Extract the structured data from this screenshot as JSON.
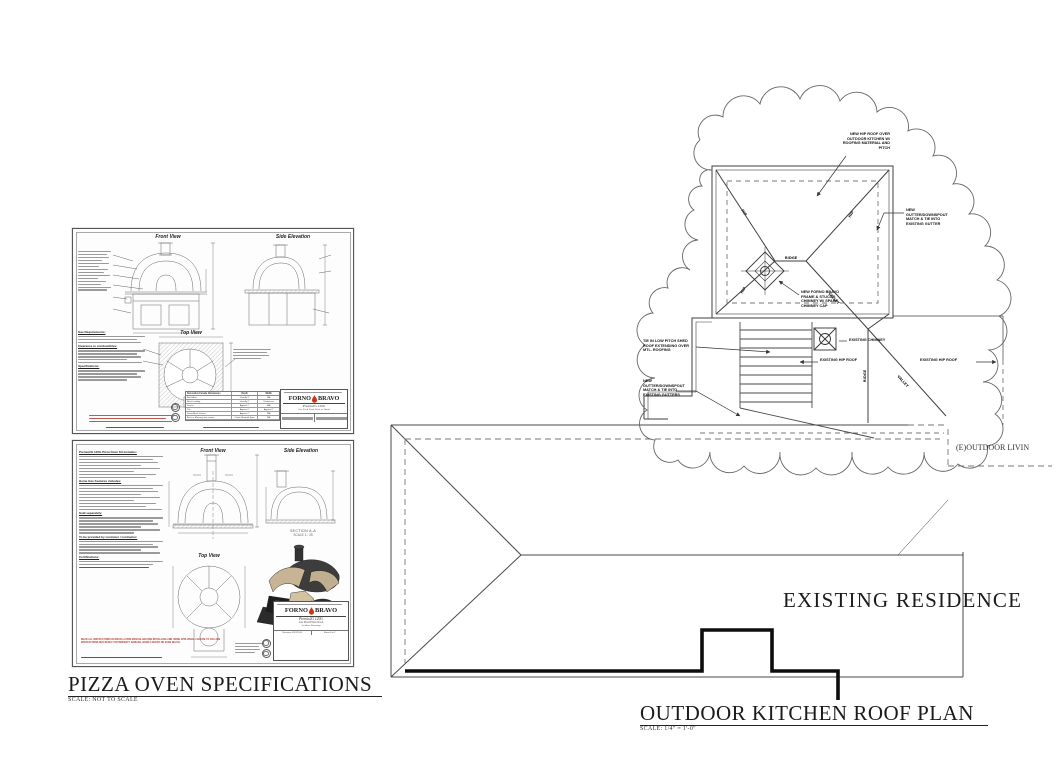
{
  "page": {
    "background": "#ffffff"
  },
  "colors": {
    "line": "#4a4a4a",
    "wall": "#111111",
    "warning_red": "#b3362c",
    "link_blue": "#3a56b4",
    "logo_flame": "#cc3311"
  },
  "pizza_specs": {
    "title": "PIZZA OVEN SPECIFICATIONS",
    "scale_note": "SCALE: NOT TO SCALE",
    "sheet1": {
      "front_view": "Front View",
      "side_elevation": "Side Elevation",
      "top_view": "Top View",
      "sec_gas": "Gas Requirements:",
      "sec_clearance": "Clearance to combustibles:",
      "sec_specs": "Specifications:",
      "table": {
        "title": "Decorative Facade Allowances",
        "col_depth": "Depth",
        "col_width": "Width",
        "rows": [
          {
            "name": "Brick Arch",
            "depth": "Usually 5\"",
            "width": "N/A"
          },
          {
            "name": "Brick Landing",
            "depth": "Usually 2\"",
            "width": "Preference"
          },
          {
            "name": "Stucco",
            "depth": "Approx 1\"",
            "width": "N/A"
          },
          {
            "name": "Tile",
            "depth": "Approx 1\"",
            "width": "Approx 2\""
          },
          {
            "name": "Stone/Brick Veneer",
            "depth": "Approx 1\"",
            "width": "N/A"
          },
          {
            "name": "Brick or Masonry not veneer",
            "depth": "Check Material Spec",
            "width": "N/A"
          }
        ]
      },
      "brand_left": "FORNO",
      "brand_right": "BRAVO",
      "model": "Premio2G 120G",
      "product": "Gas Fired Pizza Oven w/ Stand"
    },
    "sheet2": {
      "kit_heading": "Premio2G 120G Pizza Oven Kit includes:",
      "gas_heading": "Home Gas Features includes:",
      "sold_heading": "Sold separately:",
      "provided_heading": "To be provided by customer / contractor:",
      "cert_heading": "Certifications:",
      "front_view": "Front View",
      "side_elevation": "Side Elevation",
      "top_view": "Top View",
      "section_label": "SECTION A-A",
      "section_scale": "SCALE 1 : 25",
      "brand_left": "FORNO",
      "brand_right": "BRAVO",
      "model": "Premio2G 120G",
      "product": "Gas Fired Pizza Oven",
      "drawing_type": "Architect Drawings",
      "revision": "Revision: 4/12/2016",
      "sheet_no": "Sheet 6 of 7",
      "warning": "READ ALL INSTRUCTIONS IN INSTALLATION MANUAL BEFORE INSTALLING AND USING APPLIANCE. FAILURE TO FOLLOW INSTRUCTIONS MAY RESULT IN PROPERTY DAMAGE, BODILY INJURY OR EVEN DEATH."
    }
  },
  "roof_plan": {
    "title": "OUTDOOR KITCHEN ROOF PLAN",
    "scale_note": "SCALE: 1/4\" = 1'-0\"",
    "existing_residence": "EXISTING RESIDENCE",
    "outdoor_living": "(E)OUTDOOR LIVIN",
    "annotations": {
      "new_roof": "NEW HIP ROOF OVER\nOUTDOOR KITCHEN W/\nROOFING MATERIAL AND\nPITCH",
      "gutter_right": "NEW GUTTER/DOWNSPOUT\nMATCH & TIE INTO\nEXISTING GUTTER",
      "new_chimney": "NEW FORNO BRAVO\nFRAME & STUCCO\nCHIMNEY W/ SPARK\nCHIMNEY CAP",
      "shed_roof": "TIE IN LOW PITCH SHED\nROOF EXTENDING OVER\nMTL. ROOFING",
      "gutter_left": "NEW GUTTER/DOWNSPOUT\nMATCH & TIE INTO\nEXISTING GUTTERS",
      "existing_chimney": "EXISTING CHIMNEY",
      "existing_hip_left": "EXISTING HIP ROOF",
      "existing_hip_right": "EXISTING HIP ROOF",
      "ridge": "RIDGE",
      "ridge_vertical": "RIDGE",
      "hip": "HIP",
      "valley": "VALLEY"
    }
  }
}
